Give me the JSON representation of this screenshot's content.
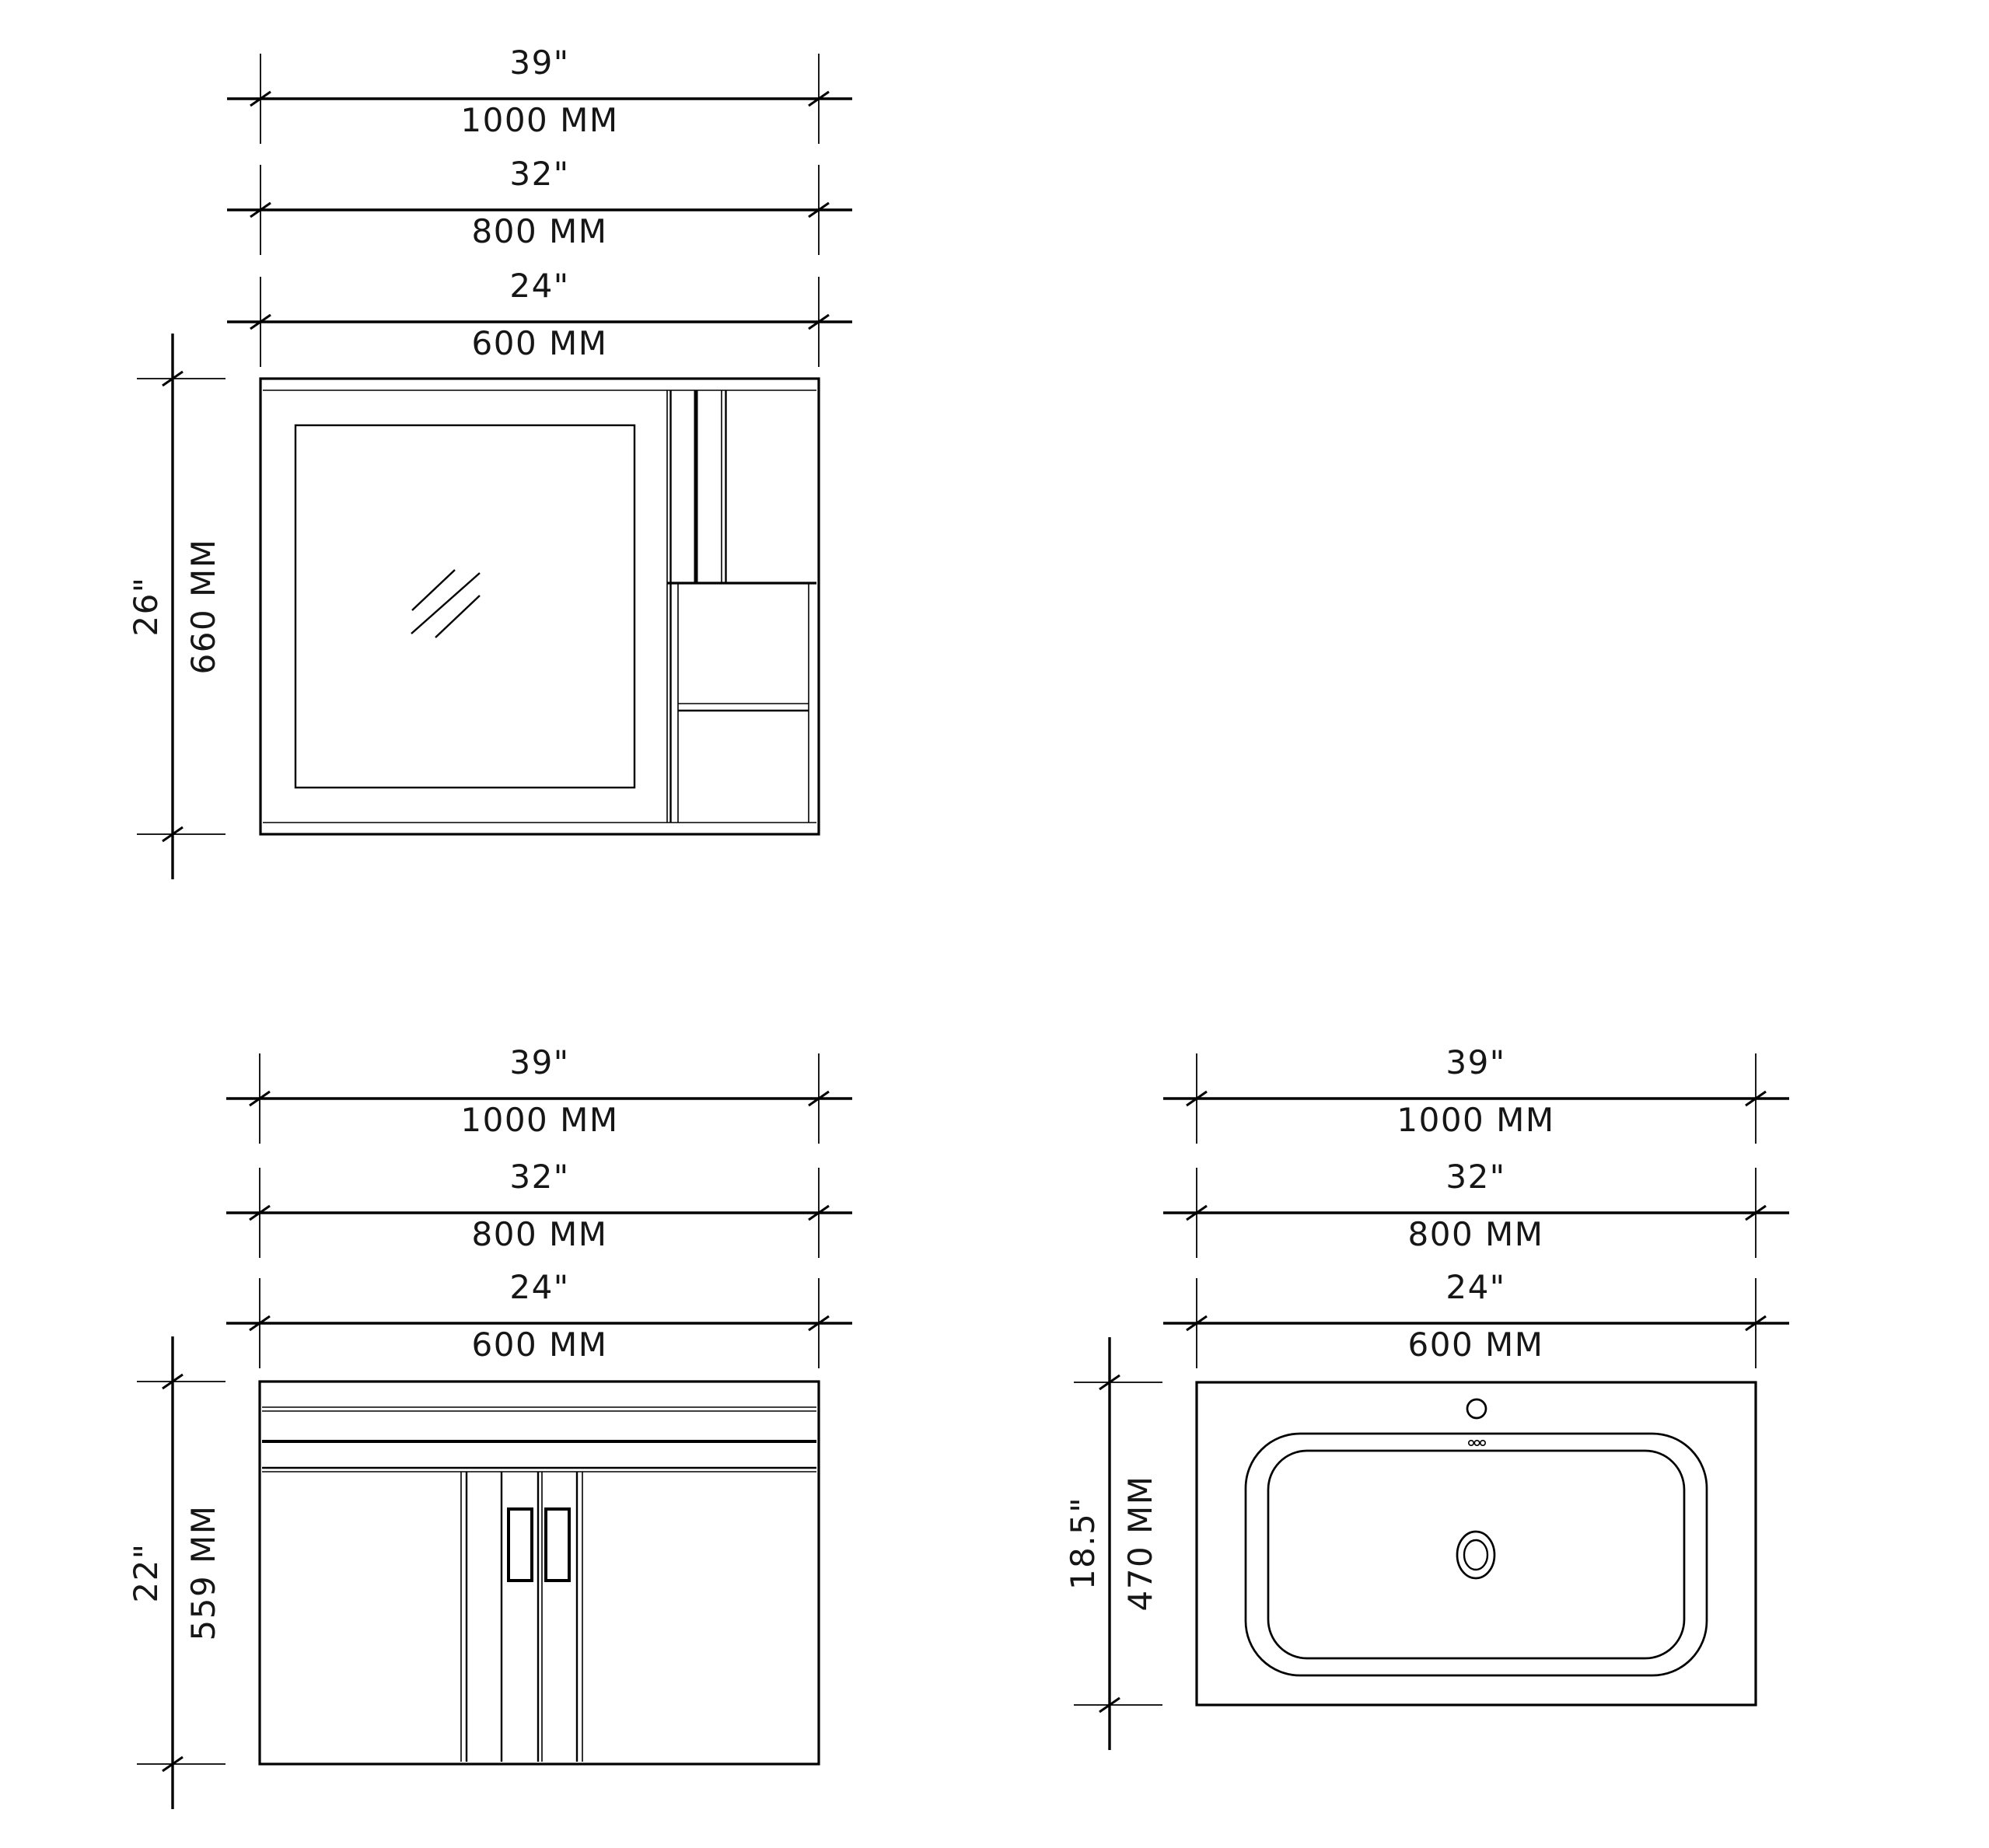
{
  "drawing": {
    "background": "#ffffff",
    "line_color": "#000000"
  },
  "views": {
    "mirror": {
      "width_dims": [
        {
          "in": "39\"",
          "mm": "1000 MM"
        },
        {
          "in": "32\"",
          "mm": "800 MM"
        },
        {
          "in": "24\"",
          "mm": "600 MM"
        }
      ],
      "height_dim": {
        "in": "26\"",
        "mm": "660 MM"
      }
    },
    "vanity": {
      "width_dims": [
        {
          "in": "39\"",
          "mm": "1000 MM"
        },
        {
          "in": "32\"",
          "mm": "800 MM"
        },
        {
          "in": "24\"",
          "mm": "600 MM"
        }
      ],
      "height_dim": {
        "in": "22\"",
        "mm": "559 MM"
      }
    },
    "sink": {
      "width_dims": [
        {
          "in": "39\"",
          "mm": "1000 MM"
        },
        {
          "in": "32\"",
          "mm": "800 MM"
        },
        {
          "in": "24\"",
          "mm": "600 MM"
        }
      ],
      "height_dim": {
        "in": "18.5\"",
        "mm": "470 MM"
      }
    }
  }
}
